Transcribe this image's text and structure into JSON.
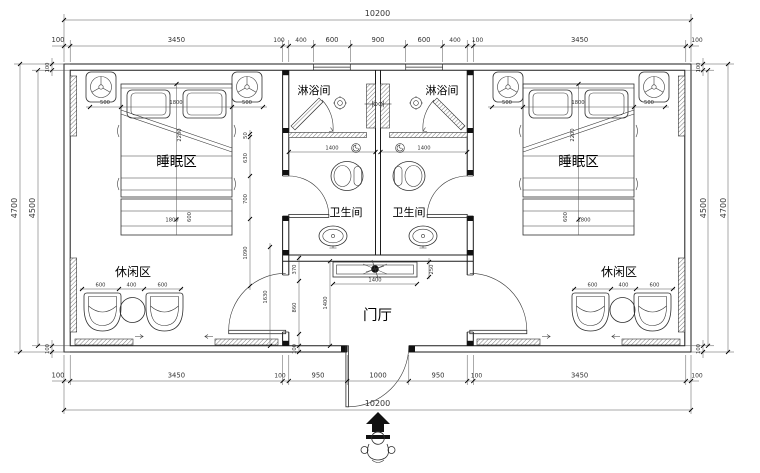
{
  "title": "twin-room floor plan drawing",
  "colors": {
    "line": "#1b1b1b",
    "dim_text": "#333333",
    "background": "#ffffff"
  },
  "labels": {
    "shower_left": "淋浴间",
    "shower_right": "淋浴间",
    "wc_left": "卫生间",
    "wc_right": "卫生间",
    "sleep_left": "睡眠区",
    "sleep_right": "睡眠区",
    "leisure_left": "休闲区",
    "leisure_right": "休闲区",
    "foyer": "门厅"
  },
  "dims": {
    "overall_top": "10200",
    "overall_bottom": "10200",
    "top_chain": [
      "100",
      "3450",
      "100",
      "400",
      "600",
      "900",
      "600",
      "400",
      "100",
      "3450",
      "100"
    ],
    "bottom_chain": [
      "100",
      "3450",
      "100",
      "950",
      "1000",
      "950",
      "100",
      "3450",
      "100"
    ],
    "left_outer": "4700",
    "left_inner": "4500",
    "right_inner": "4500",
    "right_outer": "4700",
    "tl_wall": "100",
    "bl_wall": "100",
    "tr_wall": "100",
    "br_wall": "100",
    "bed_left": [
      "500",
      "1800",
      "500"
    ],
    "bed_left_len": "2200",
    "bench_left_w": "1800",
    "bench_left_d": "600",
    "bed_right": [
      "500",
      "1800",
      "500"
    ],
    "bed_right_len": "2200",
    "bench_right_w": "1800",
    "bench_right_d": "600",
    "leisure_left": [
      "600",
      "400",
      "600"
    ],
    "leisure_right": [
      "600",
      "400",
      "600"
    ],
    "shower_left_w": "1400",
    "shower_right_w": "1400",
    "core_wall_chain": [
      "50",
      "630",
      "700",
      "1090"
    ],
    "room_door": "1630",
    "foyer_side": [
      "370",
      "860",
      "100"
    ],
    "foyer_depth": "1400",
    "console_w": "1400",
    "console_d": "250"
  }
}
